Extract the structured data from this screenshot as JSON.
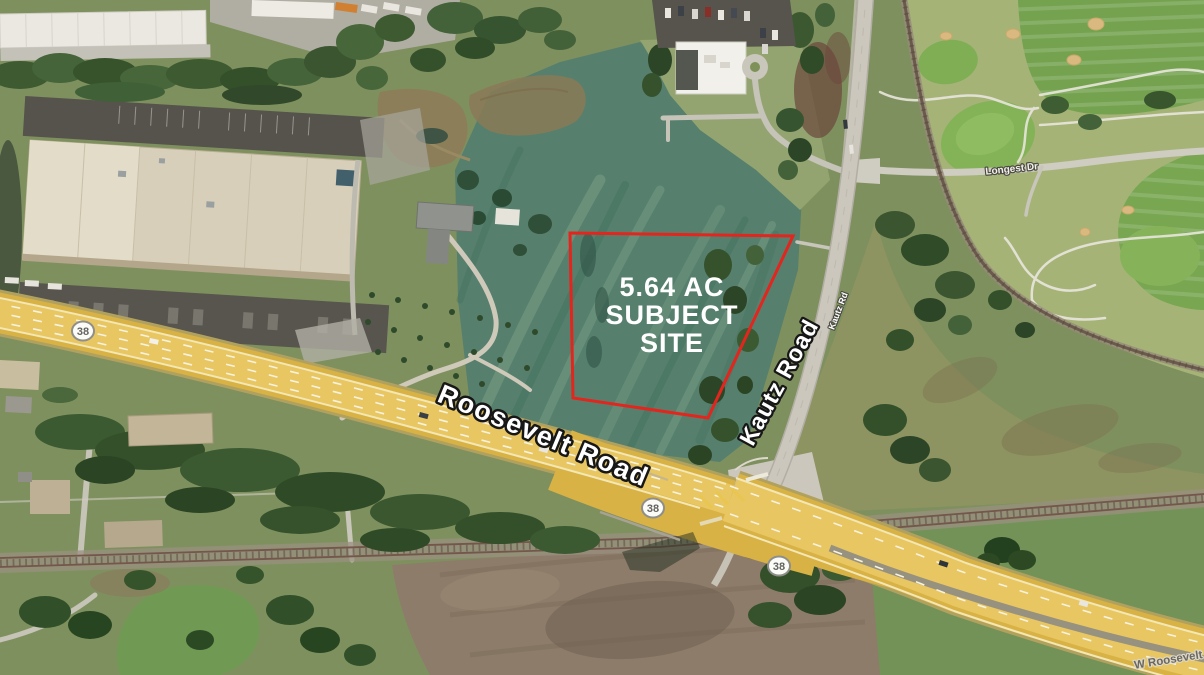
{
  "map": {
    "site": {
      "label_line1": "5.64 AC",
      "label_line2": "SUBJECT",
      "label_line3": "SITE",
      "outline_color": "#e3251d"
    },
    "labels": {
      "roosevelt_road": "Roosevelt Road",
      "kautz_road": "Kautz Road",
      "kautz_rd_small": "Kautz Rd",
      "longest_dr": "Longest Dr",
      "w_roosevelt_rd": "W Roosevelt Rd"
    },
    "route_shields": [
      {
        "route": "38"
      },
      {
        "route": "38"
      },
      {
        "route": "38"
      }
    ],
    "colors": {
      "highway_yellow": "#d9b245",
      "field_teal": "#56806d",
      "golf_base": "#a5b377",
      "label_white": "#ffffff"
    }
  }
}
